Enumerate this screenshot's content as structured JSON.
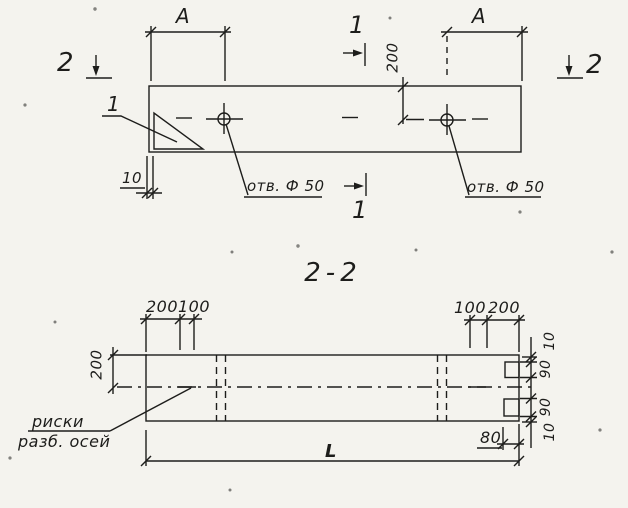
{
  "colors": {
    "paper": "#f4f3ee",
    "ink": "#1d1d1b"
  },
  "top_view": {
    "dim_a_left": "A",
    "dim_a_right": "A",
    "section_2_left": "2",
    "section_2_right": "2",
    "section_1_top": "1",
    "section_1_bottom": "1",
    "detail_mark": "1",
    "dim_200": "200",
    "dim_10": "10",
    "hole_label_left": "отв. Ф 50",
    "hole_label_right": "отв. Ф 50"
  },
  "section_view": {
    "title": "2-2",
    "dim_left_200": "200",
    "top_left_dims": {
      "d200": "200",
      "d100": "100"
    },
    "top_right_dims": {
      "d100": "100",
      "d200": "200"
    },
    "right_dims": {
      "top10": "10",
      "top90": "90",
      "bottom90": "90",
      "bottom10": "10"
    },
    "dim_80": "80",
    "dim_length": "L",
    "axis_note_line1": "риски",
    "axis_note_line2": "разб. осей"
  }
}
